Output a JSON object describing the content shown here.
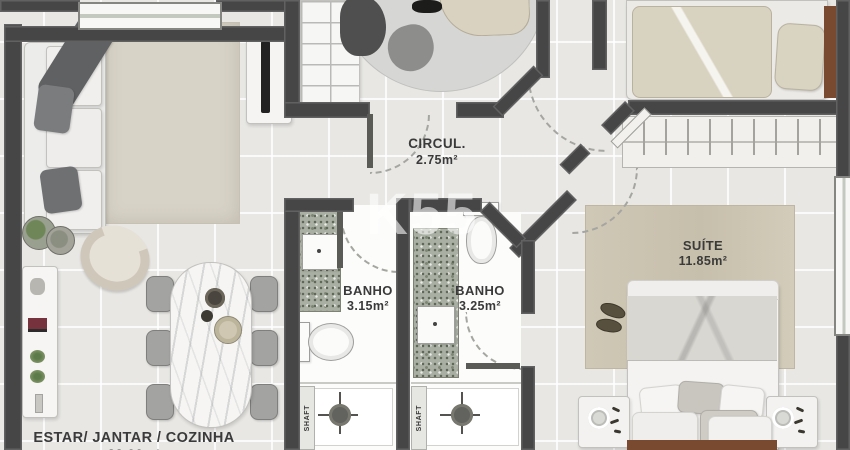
{
  "watermark": {
    "text": "K55"
  },
  "rooms": {
    "living": {
      "name": "ESTAR/ JANTAR / COZINHA",
      "area": "22.00m²"
    },
    "circulation": {
      "name": "CIRCUL.",
      "area": "2.75m²"
    },
    "bath1": {
      "name": "BANHO",
      "area": "3.15m²"
    },
    "bath2": {
      "name": "BANHO",
      "area": "3.25m²"
    },
    "suite": {
      "name": "SUÍTE",
      "area": "11.85m²"
    }
  },
  "labels": {
    "shaft": "SHAFT"
  },
  "colors": {
    "wall": "#464646",
    "floor": "#e8e7e4",
    "grout": "#ffffff",
    "bath_floor": "#fcfcfb",
    "granite": "#a9afa2",
    "rug_living": "#d8d3c7",
    "rug_suite": "#cfc8b6",
    "rug_round": "#d6d6d4",
    "bed_wood": "#7a4a30",
    "blanket_beige": "#d8d2c0",
    "blanket_gray": "#d9d7d2",
    "label_text": "#3a3a3a"
  }
}
